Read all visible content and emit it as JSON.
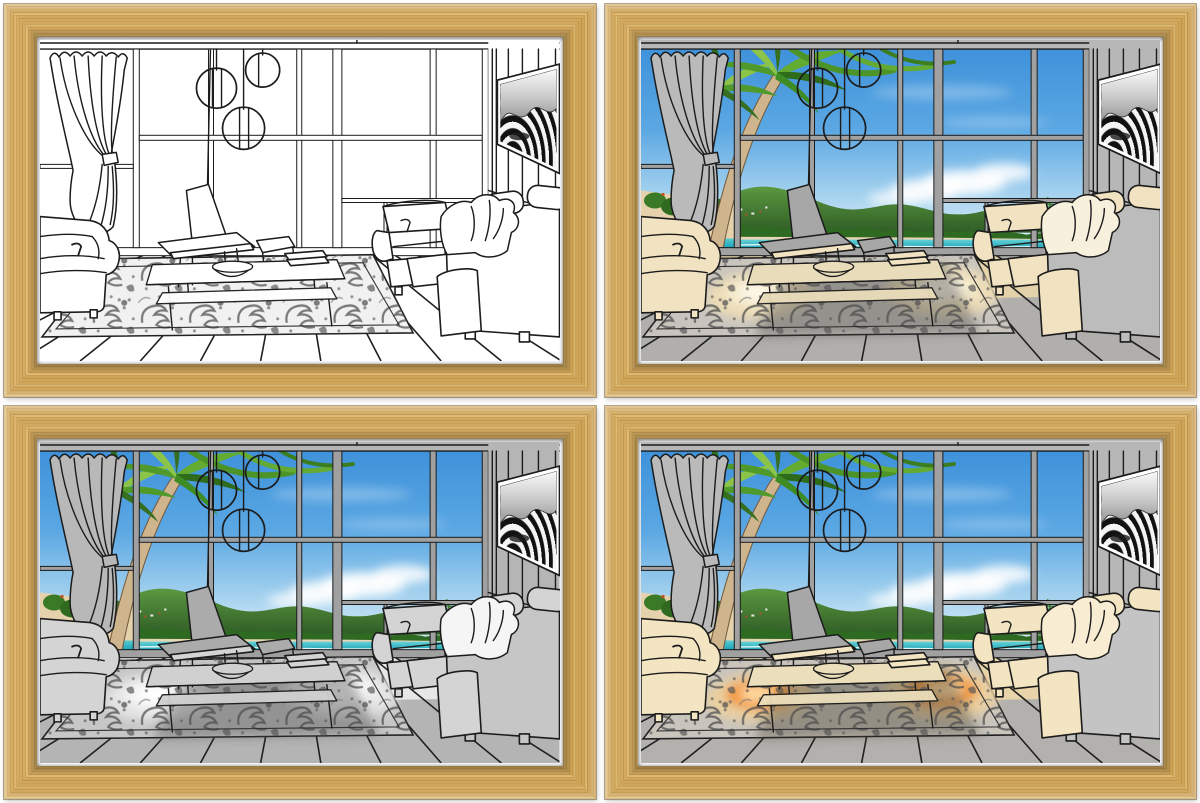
{
  "product_photo": {
    "description": "Four identical wood-framed line-art prints of a modern beach-house living room, shown in four lighting colorway variants arranged in a 2x2 grid",
    "background_color": "#ffffff",
    "grid": {
      "rows": 2,
      "cols": 2
    }
  },
  "frame": {
    "material": "light oak wood",
    "wood_color": "#d2a95f",
    "wood_grain_dark": "#a97c38",
    "wood_highlight": "#eece8a",
    "mat_color": "#ffffff"
  },
  "scene": {
    "elements": [
      "tied curtain",
      "palm trees",
      "tropical sea view",
      "green hills",
      "clouds",
      "round pendant lamps",
      "lounge chair with ottoman",
      "coffee table with bowl and books",
      "left armchair",
      "right armchair",
      "sofa with pillows and throw blanket",
      "damask area rug",
      "plank deck floor",
      "slatted wall with op-art TV panel"
    ],
    "line_color": "#1c1c1c",
    "view_colors": {
      "sky_top": "#3f92da",
      "sky_horizon": "#e6f2fa",
      "hills": "#2f5d26",
      "sea": "#1ba4ba",
      "sand": "#e7d6b4",
      "palm_green": "#4f9a2b",
      "trunk": "#c8ac85"
    }
  },
  "panels": [
    {
      "id": "top-left",
      "variant": "v1",
      "name": "uncolored-line-art",
      "description": "Plain black-and-white sketch, windows empty",
      "palette": {
        "wall": "#ffffff",
        "mullion": "#ffffff",
        "curtain": "#ffffff",
        "deck": "#ffffff",
        "deckpatch": "rgba(0,0,0,0)",
        "furn": "#ffffff",
        "furnback": "#ffffff",
        "shell": "#ffffff",
        "table": "#ffffff",
        "blanket": "#ffffff",
        "rugbase": "#f1f1f1",
        "rugpatch": "rgba(0,0,0,0)",
        "rugpatch2": "rgba(0,0,0,0)",
        "rugpatch3": "rgba(0,0,0,0)",
        "rugshade": "rgba(0,0,0,0)",
        "view": "none"
      }
    },
    {
      "id": "top-right",
      "variant": "v2",
      "name": "beach-view-warm-daylight",
      "description": "Ocean view in windows, warm cream sunlight on furniture and rug",
      "palette": {
        "wall": "#b7b7b7",
        "mullion": "#a1a1a1",
        "curtain": "#bababa",
        "deck": "#b1afac",
        "deckpatch": "#e9d6a8",
        "furn": "#f1e3c1",
        "furnback": "#bcbcbc",
        "shell": "#a7a7a7",
        "table": "#e9dcba",
        "blanket": "#f7f0dd",
        "rugbase": "#c9c5be",
        "rugpatch": "#ecdcb6",
        "rugpatch2": "#f5ebce",
        "rugpatch3": "#fdf7e8",
        "rugshade": "rgba(70,70,70,0.40)",
        "view": "block"
      }
    },
    {
      "id": "bottom-left",
      "variant": "v3",
      "name": "beach-view-neutral-light",
      "description": "Ocean view in windows, neutral gray interior with white light pools",
      "palette": {
        "wall": "#b5b5b5",
        "mullion": "#a0a0a0",
        "curtain": "#b8b8b8",
        "deck": "#b4b4b4",
        "deckpatch": "#ececec",
        "furn": "#d4d4d4",
        "furnback": "#c6c6c6",
        "shell": "#ababab",
        "table": "#d0d0d0",
        "blanket": "#f5f5f5",
        "rugbase": "#c7c7c7",
        "rugpatch": "#e4e4e4",
        "rugpatch2": "#f4f4f4",
        "rugpatch3": "#ffffff",
        "rugshade": "rgba(70,70,70,0.40)",
        "view": "block"
      }
    },
    {
      "id": "bottom-right",
      "variant": "v4",
      "name": "beach-view-orange-glow",
      "description": "Ocean view in windows, warm furniture with glowing orange lamplight pools on the rug",
      "palette": {
        "wall": "#b7b7b7",
        "mullion": "#a1a1a1",
        "curtain": "#bababa",
        "deck": "#b3b1ae",
        "deckpatch": "#ecd8a9",
        "furn": "#f3e5c2",
        "furnback": "#c4c4c4",
        "shell": "#a7a7a7",
        "table": "#ebdebb",
        "blanket": "#f8edd2",
        "rugbase": "#c9c4bc",
        "rugpatch": "#ead0a0",
        "rugpatch2": "#f1932c",
        "rugpatch3": "#ffd9a0",
        "rugshade": "rgba(70,60,50,0.40)",
        "view": "block"
      }
    }
  ]
}
